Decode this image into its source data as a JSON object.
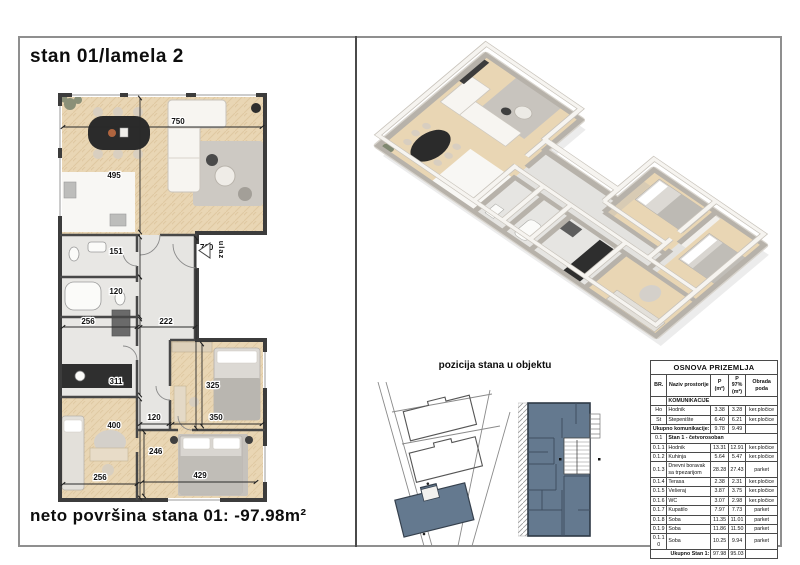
{
  "page": {
    "title": "stan 01/lamela 2",
    "net_area": "neto površina stana 01: -97.98m²",
    "position_label": "pozicija stana u objektu"
  },
  "floorplan": {
    "entrance_label": "ulaz",
    "dims": {
      "living_w": "750",
      "living_h": "495",
      "room151": "151",
      "room120": "120",
      "bath_w": "256",
      "corr_w": "222",
      "corridor_h": "760",
      "kitchen_h": "311",
      "office_h": "400",
      "bed1_h": "325",
      "corr2_w": "120",
      "bed1_w": "350",
      "bed2_h": "246",
      "bed2_w": "429",
      "office_w": "256"
    }
  },
  "table": {
    "title": "OSNOVA PRIZEMLJA",
    "col_headers": [
      "BR.",
      "Naziv prostorije",
      "P (m²)",
      "P 97% (m²)",
      "Obrada poda"
    ],
    "rows": [
      {
        "type": "section",
        "br": "",
        "label": "KOMUNIKACIJE"
      },
      {
        "br": "Ho",
        "name": "Hodnik",
        "p": "3.38",
        "p97": "3.28",
        "floor": "ker.pločice"
      },
      {
        "br": "St",
        "name": "Stepenište",
        "p": "6.40",
        "p97": "6.21",
        "floor": "ker.pločice"
      },
      {
        "type": "total",
        "name": "Ukupno komunikacije:",
        "p": "9.78",
        "p97": "9.49"
      },
      {
        "type": "section",
        "br": "0.1",
        "label": "Stan 1 - četvorosoban"
      },
      {
        "br": "0.1.1",
        "name": "Hodnik",
        "p": "13.31",
        "p97": "12.91",
        "floor": "ker.pločice"
      },
      {
        "br": "0.1.2",
        "name": "Kuhinja",
        "p": "5.64",
        "p97": "5.47",
        "floor": "ker.pločice"
      },
      {
        "br": "0.1.3",
        "name": "Dnevni boravak sa trpezarijom",
        "p": "28.28",
        "p97": "27.43",
        "floor": "parket"
      },
      {
        "br": "0.1.4",
        "name": "Terasa",
        "p": "2.38",
        "p97": "2.31",
        "floor": "ker.pločice"
      },
      {
        "br": "0.1.5",
        "name": "Vešeraj",
        "p": "3.87",
        "p97": "3.75",
        "floor": "ker.pločice"
      },
      {
        "br": "0.1.6",
        "name": "WC",
        "p": "3.07",
        "p97": "2.98",
        "floor": "ker.pločice"
      },
      {
        "br": "0.1.7",
        "name": "Kupatilo",
        "p": "7.97",
        "p97": "7.73",
        "floor": "parket"
      },
      {
        "br": "0.1.8",
        "name": "Soba",
        "p": "11.35",
        "p97": "11.01",
        "floor": "parket"
      },
      {
        "br": "0.1.9",
        "name": "Soba",
        "p": "11.86",
        "p97": "11.50",
        "floor": "parket"
      },
      {
        "br": "0.1.10",
        "name": "Soba",
        "p": "10.25",
        "p97": "9.94",
        "floor": "parket"
      },
      {
        "type": "total",
        "name": "Ukupno Stan 1:",
        "p": "97.98",
        "p97": "95.03"
      }
    ]
  },
  "colors": {
    "highlight_slate": "#64798f",
    "wood_floor": "#e9d6b4",
    "tile_floor": "#e6e5e2",
    "wall_dark": "#3c3c3c"
  }
}
